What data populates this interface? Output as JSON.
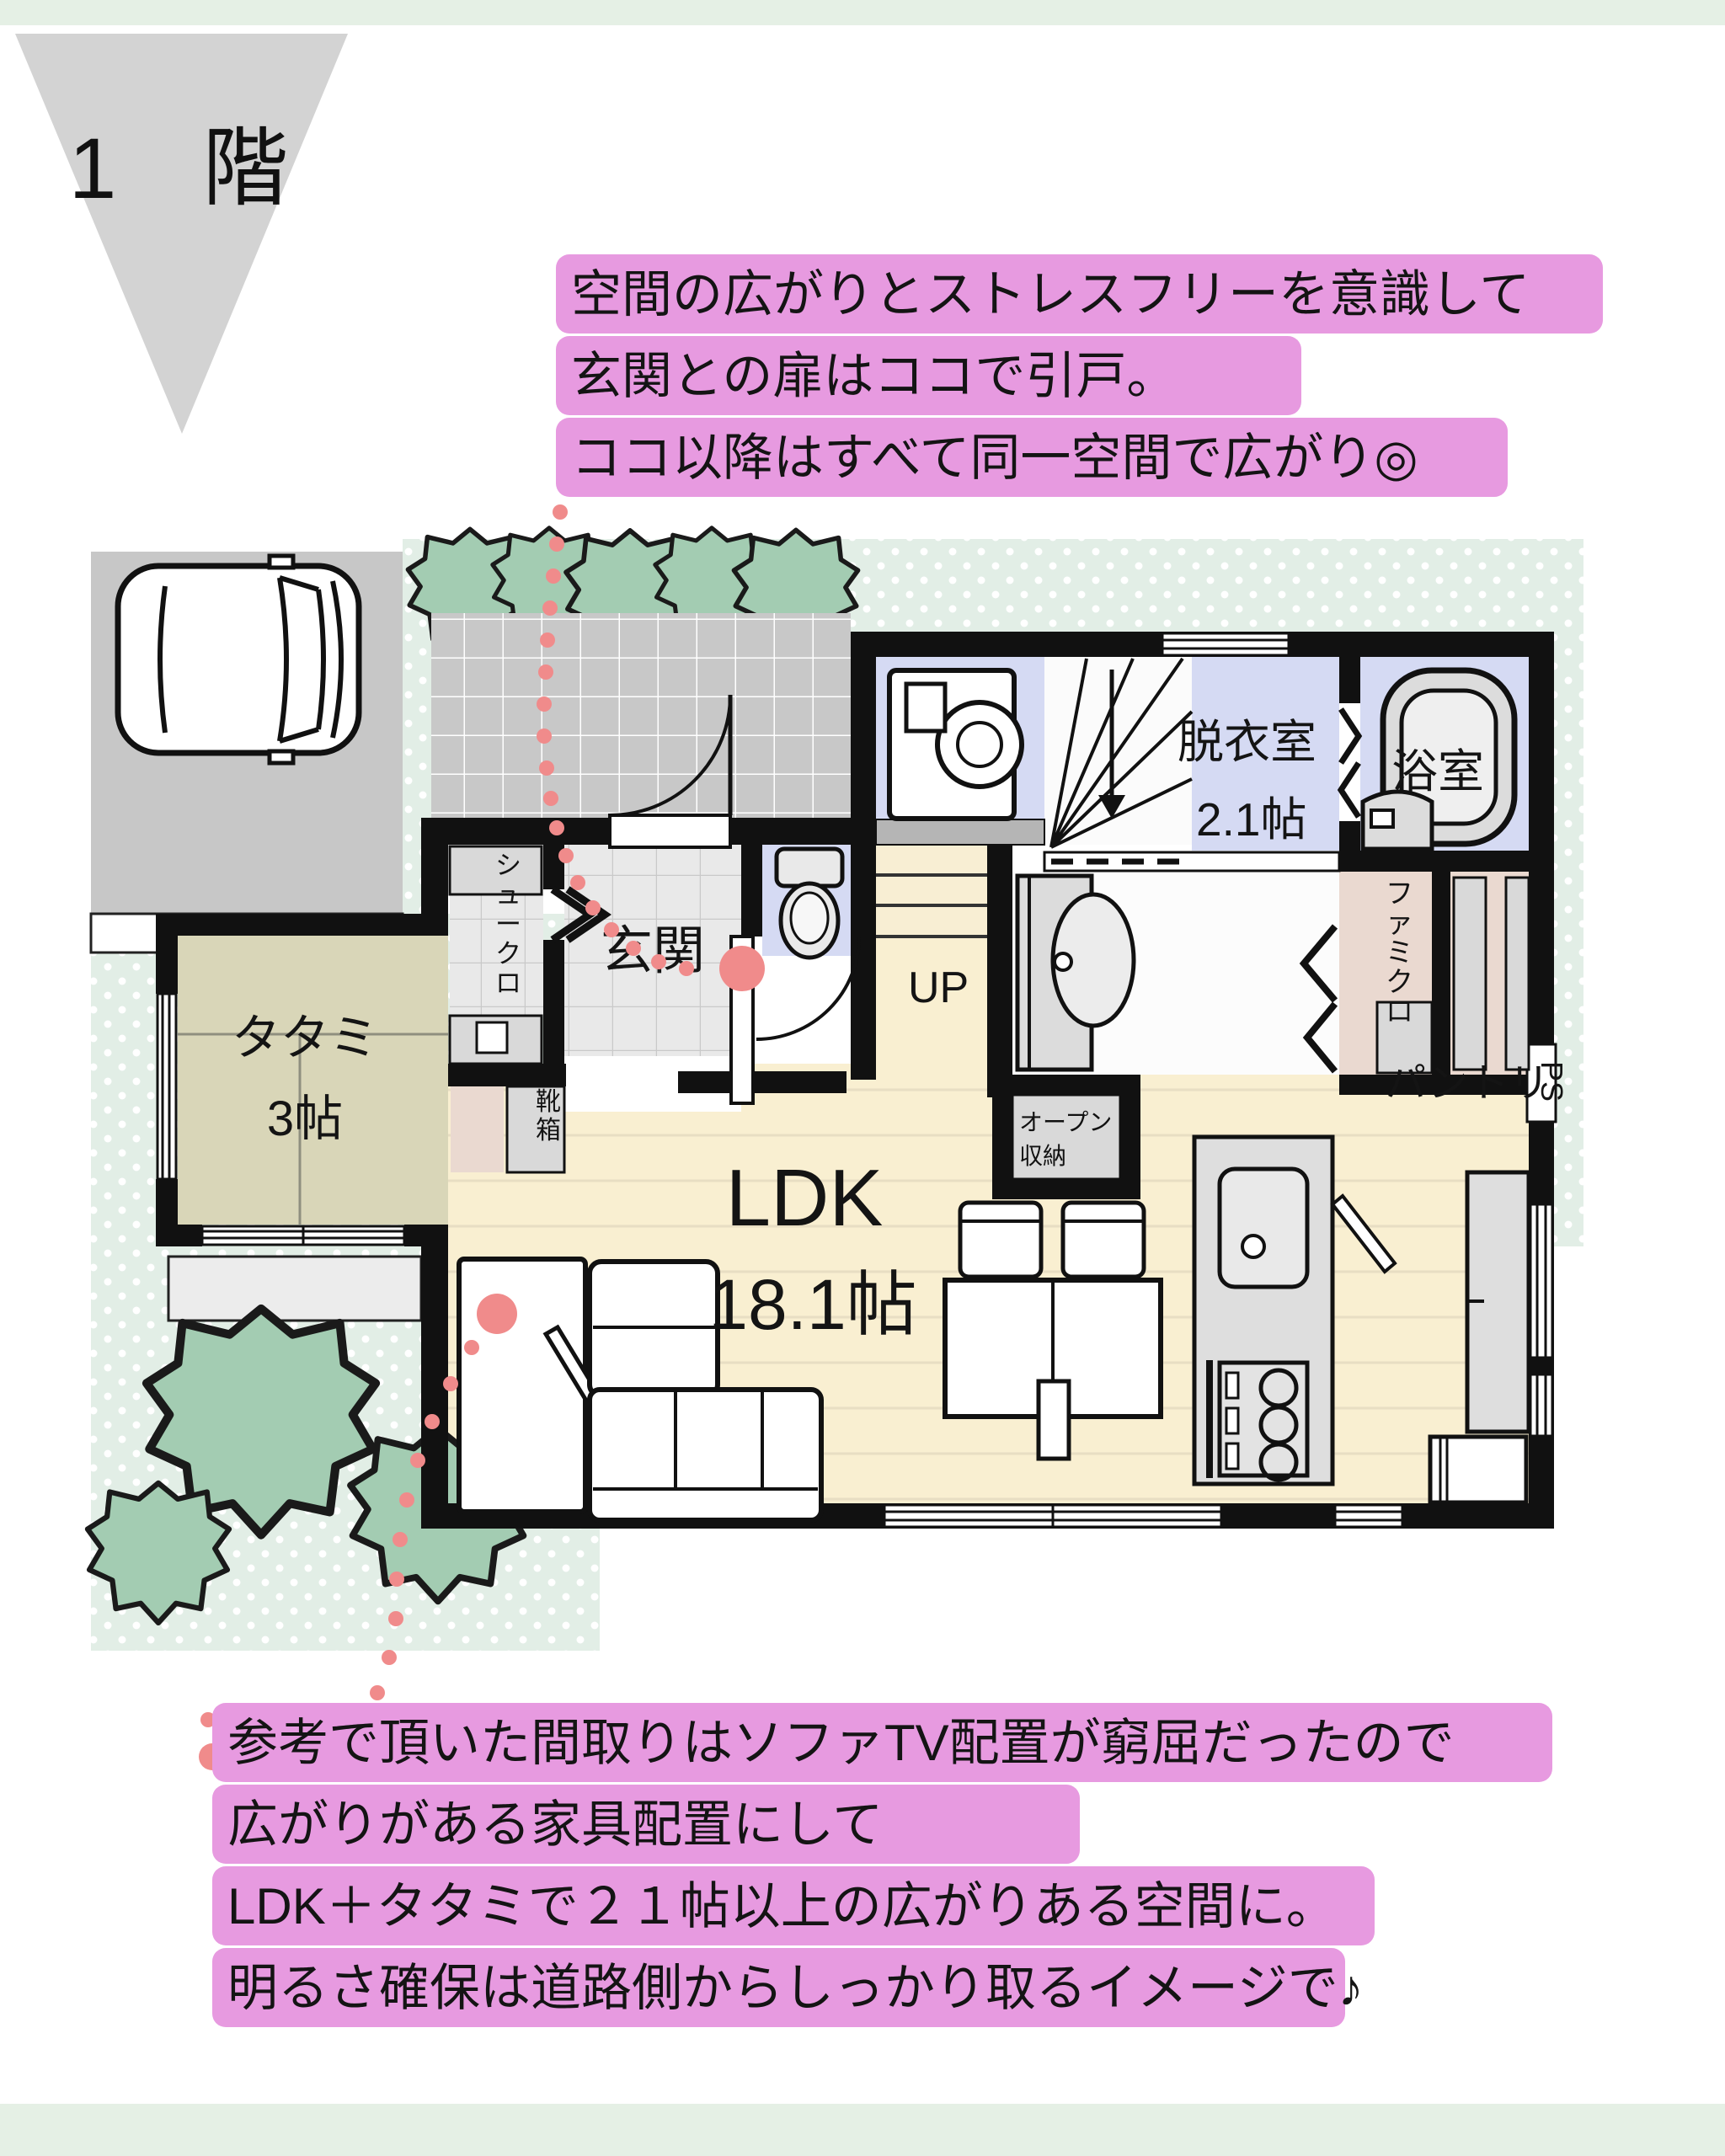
{
  "title": {
    "floor": "1　階"
  },
  "annotations": {
    "top": {
      "lines": [
        "空間の広がりとストレスフリーを意識して",
        "玄関との扉はココで引戸。",
        "ココ以降はすべて同一空間で広がり◎"
      ]
    },
    "bottom": {
      "lines": [
        "参考で頂いた間取りはソファTV配置が窮屈だったので",
        "広がりがある家具配置にして",
        "LDK＋タタミで２１帖以上の広がりある空間に。",
        "明るさ確保は道路側からしっかり取るイメージで♪"
      ]
    }
  },
  "rooms": {
    "genkan": {
      "label": "玄関"
    },
    "shoe_closet": {
      "label": "シュークロ"
    },
    "shoe_box": {
      "label": "靴箱"
    },
    "tatami": {
      "label": "タタミ",
      "size": "3帖"
    },
    "ldk": {
      "label": "LDK",
      "size": "18.1帖"
    },
    "dressing": {
      "label": "脱衣室",
      "size": "2.1帖"
    },
    "bath": {
      "label": "浴室"
    },
    "family_closet": {
      "label": "ファミクロ"
    },
    "pantry": {
      "label": "パントリ"
    },
    "open_storage": {
      "line1": "オープン",
      "line2": "収納"
    },
    "stairs": {
      "label": "UP"
    },
    "pipe_space": {
      "label": "PS"
    }
  },
  "colors": {
    "highlight_pink": "#e79ae0",
    "leader_dot": "#f08b8b",
    "page_band_mint": "#e5f0e5",
    "site_dotted_mint": "#e2eee6",
    "wall_black": "#111111",
    "wood_floor": "#f9efd1",
    "tatami_floor": "#d9d6b8",
    "wet_room_blue": "#d5daf3",
    "closet_beige": "#ead9d0",
    "tile_gray": "#c9c9c9",
    "tree_green": "#a3ccb2"
  }
}
